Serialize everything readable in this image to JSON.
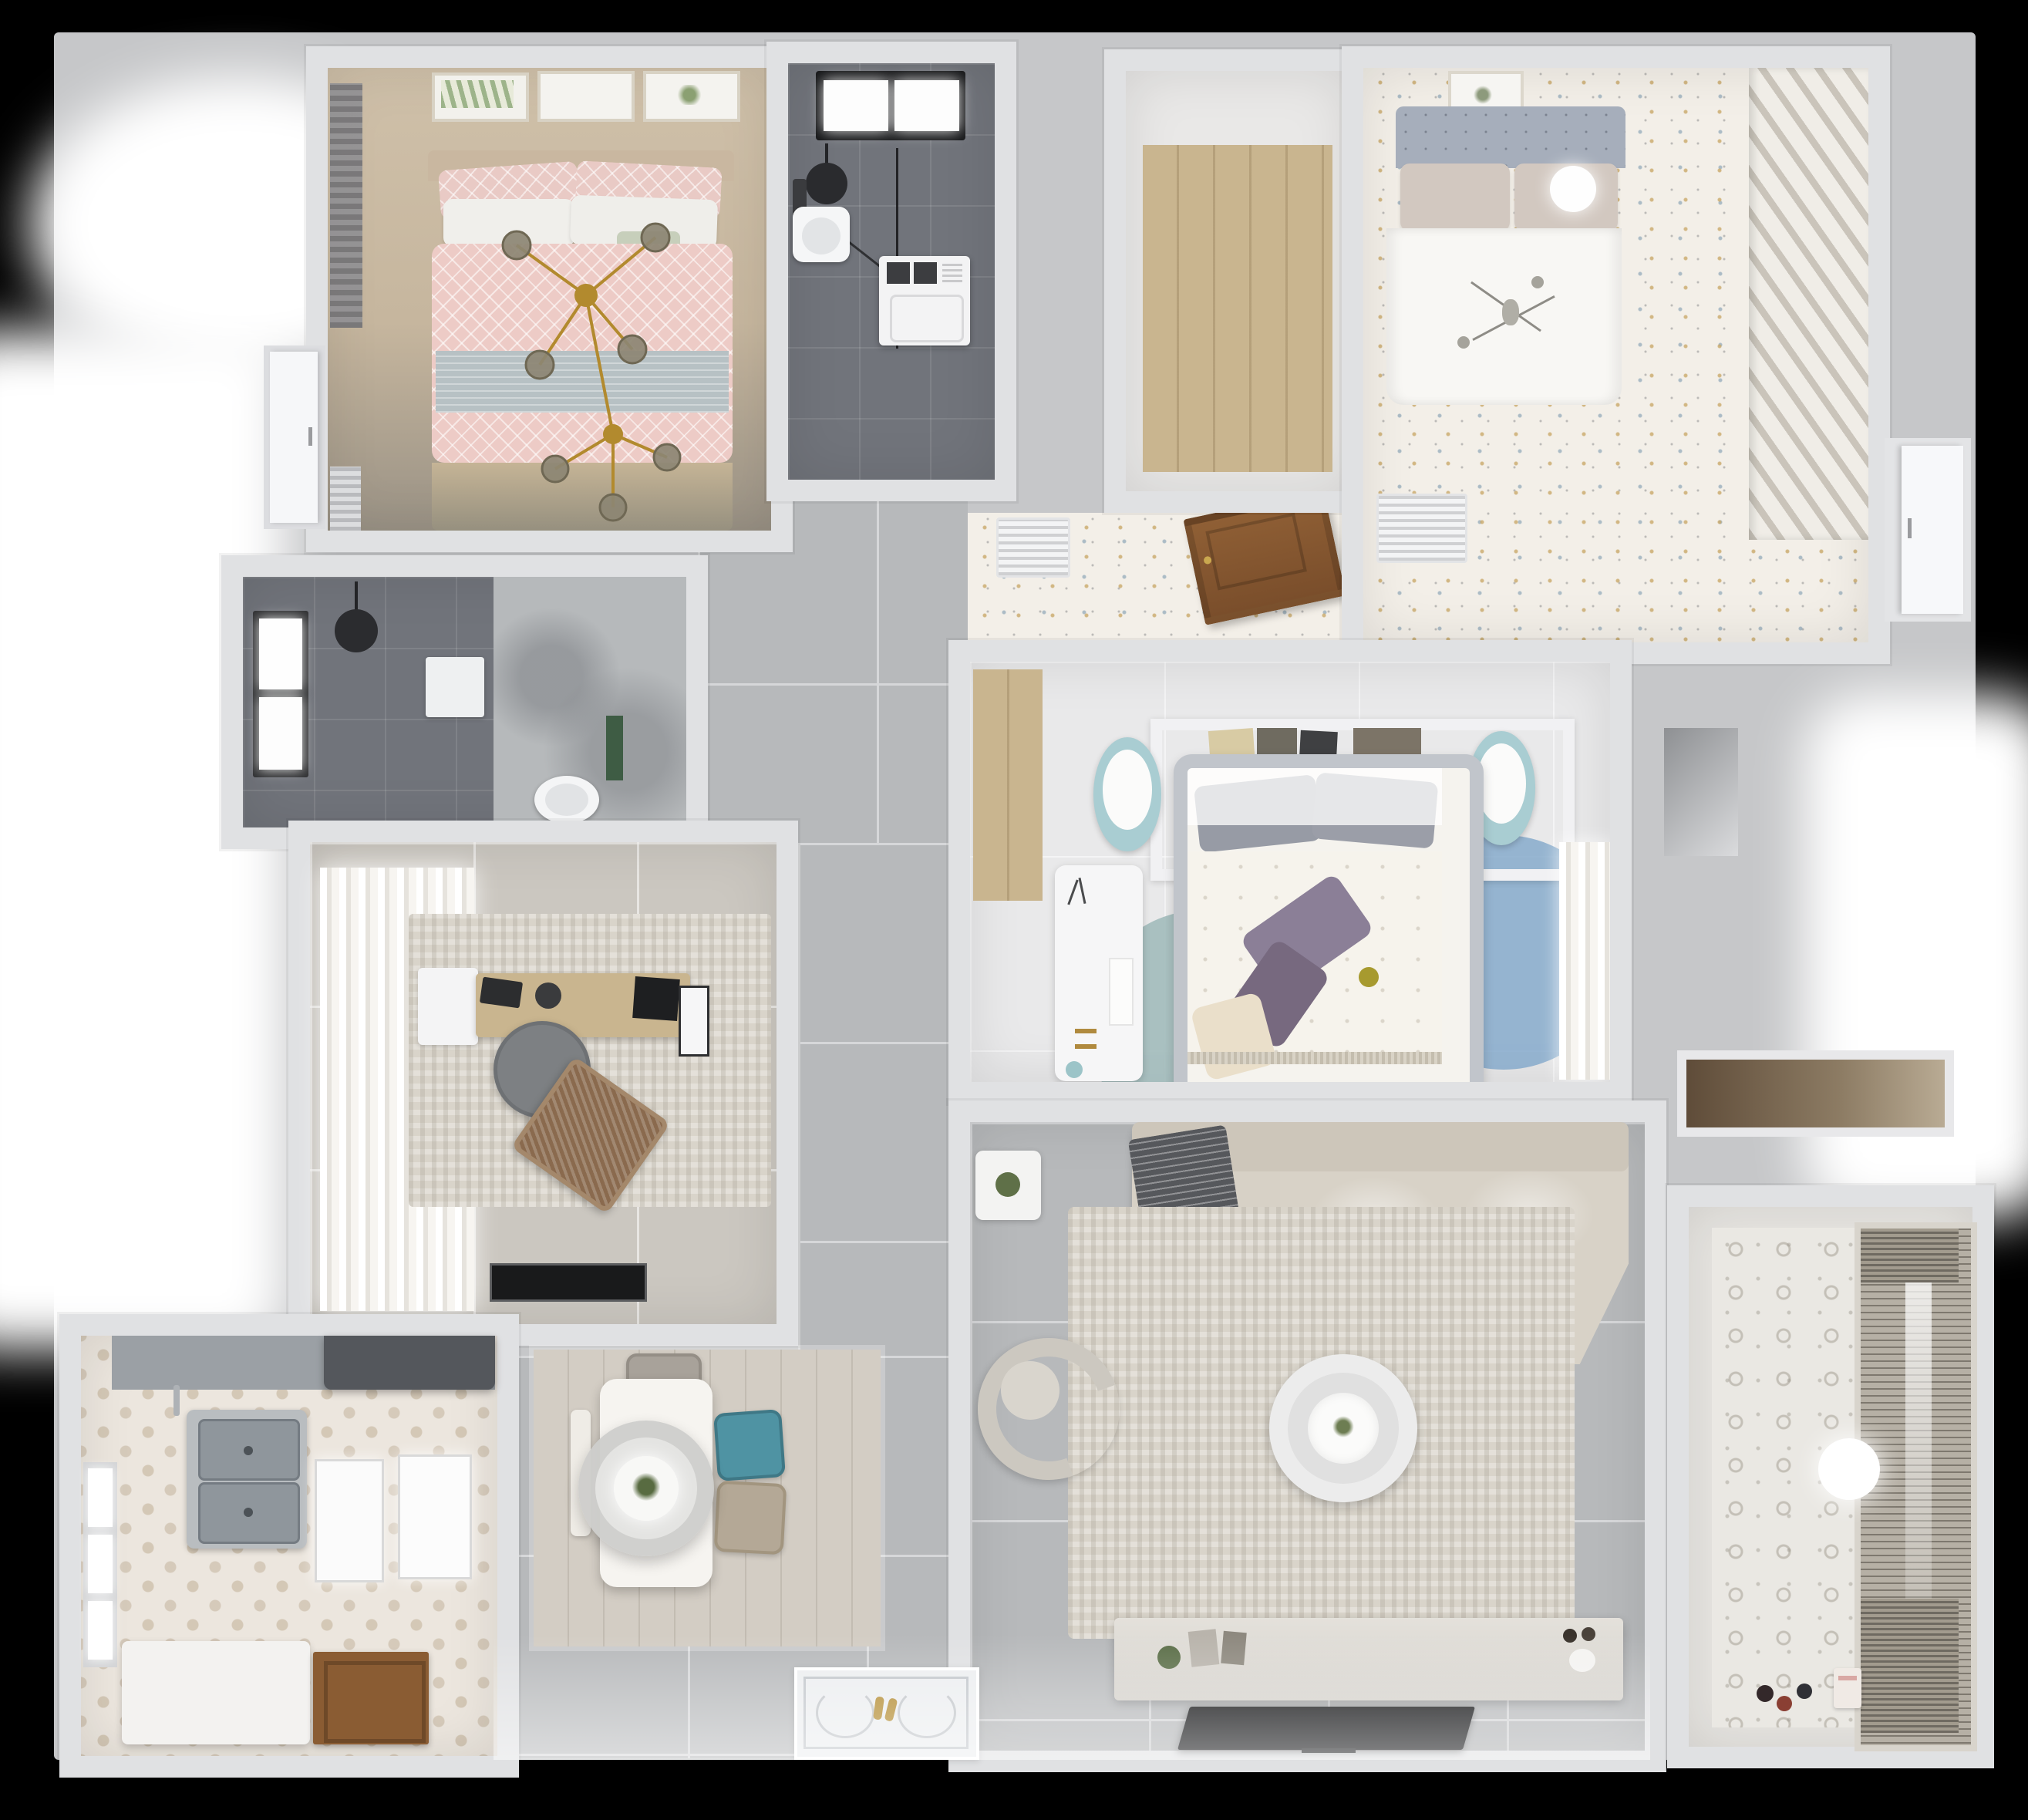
{
  "scene": {
    "type": "3d-floorplan-top-view",
    "description": "Photorealistic top-down 3D render of a furnished apartment",
    "background": "#000000"
  },
  "colors": {
    "wall": "#e0e1e3",
    "slab": "#c6c7c9",
    "hall": "#b7b9bb",
    "b1floor": "#c6b69e",
    "bathdark": "#71747b",
    "marble": "#b6b9bb",
    "wood": "#c9b58f",
    "doorwood": "#8a5c33",
    "speckle": "#f3efe8",
    "studyfloor": "#cbc7c0",
    "masterfloor": "#e9e9ea",
    "livingrug": "#d9d4ca",
    "kitchenfloor": "#ece6de",
    "diningfloor": "#d3cdc4",
    "balconyfloor": "#e7e5e1",
    "pink": "#edcbc6",
    "blanket": "#b7c1c4",
    "sofa": "#d8d2c7",
    "rugteal": "#9db8b9",
    "rugmauve": "#a9909a",
    "rugblue": "#7fa6c9",
    "gold": "#b28a2e",
    "tealchair": "#4f93a3",
    "beigechair": "#b4a896",
    "graychair": "#7d8083",
    "purple": "#8b7f97",
    "cream": "#eadfca",
    "tv": "#0c0d0f",
    "headboard2": "#a6aebb",
    "curtain": "#e6e3dd"
  },
  "rooms": [
    {
      "id": "bedroom-1",
      "name": "Bedroom 1 - pink double bed",
      "items": [
        "picture-frames",
        "window-curtain",
        "pink-bed",
        "pillows",
        "gold-sputnik-chandelier",
        "blue-blanket",
        "radiator"
      ]
    },
    {
      "id": "bathroom-1",
      "name": "Bathroom 1 - dark tiled shower room",
      "items": [
        "skylight-window",
        "shower-head",
        "glass-shower-screen",
        "toilet",
        "washing-machine"
      ]
    },
    {
      "id": "walk-in-closet",
      "name": "Walk-in closet - wood floor",
      "items": [
        "wood-plank-floor"
      ]
    },
    {
      "id": "bedroom-2",
      "name": "Bedroom 2 - white bed, speckled floor",
      "items": [
        "picture-frame",
        "tufted-headboard",
        "white-duvet-bed",
        "round-wall-light",
        "mini-chandelier",
        "slatted-wardrobe",
        "floor-vent"
      ]
    },
    {
      "id": "vestibule",
      "name": "Vestibule in front of bedroom 2",
      "items": [
        "open-wood-door",
        "floor-vent"
      ]
    },
    {
      "id": "bathroom-2",
      "name": "Bathroom 2 - dark tiles and marble",
      "items": [
        "window",
        "shower-head",
        "wall-shelf",
        "toilet",
        "plant-shelf"
      ]
    },
    {
      "id": "study",
      "name": "Study - desk and lounge chair",
      "items": [
        "sheer-curtains",
        "area-rug",
        "wood-desk",
        "laptop",
        "monitor",
        "desk-chair",
        "rattan-lounge-chair",
        "black-doormat",
        "white-side-table"
      ]
    },
    {
      "id": "master-bedroom",
      "name": "Master bedroom - floral duvet bed",
      "items": [
        "headboard-shelf",
        "books",
        "two-round-stools",
        "double-bed",
        "purple-pillows",
        "round-color-rug",
        "white-desk",
        "sheer-curtains",
        "wood-nook"
      ]
    },
    {
      "id": "living-room",
      "name": "Living room - sectional sofa and TV",
      "items": [
        "side-table-plant",
        "l-shaped-sofa",
        "gray-throw",
        "area-rug",
        "round-coffee-table",
        "armchair",
        "tv-console",
        "flat-tv"
      ]
    },
    {
      "id": "kitchen",
      "name": "Kitchen - hexagon tile floor",
      "items": [
        "range-hood",
        "countertop",
        "double-sink",
        "white-cabinet-panels",
        "island-bench",
        "wood-door",
        "window"
      ]
    },
    {
      "id": "dining-area",
      "name": "Dining area - table for four",
      "items": [
        "dining-table",
        "pendant-lamp",
        "plant-centerpiece",
        "gray-chair",
        "teal-chair",
        "beige-chair",
        "bench"
      ]
    },
    {
      "id": "balcony",
      "name": "Balcony - patterned wall and blinds",
      "items": [
        "patterned-tile-wall",
        "venetian-blind-window",
        "ceiling-light",
        "toys",
        "toy-box"
      ]
    },
    {
      "id": "hallway",
      "name": "Hallway - large gray floor tiles",
      "items": [
        "gray-floor-tiles"
      ]
    },
    {
      "id": "entry",
      "name": "Entry - decorative doormat",
      "items": [
        "doormat",
        "gold-slippers"
      ]
    }
  ]
}
